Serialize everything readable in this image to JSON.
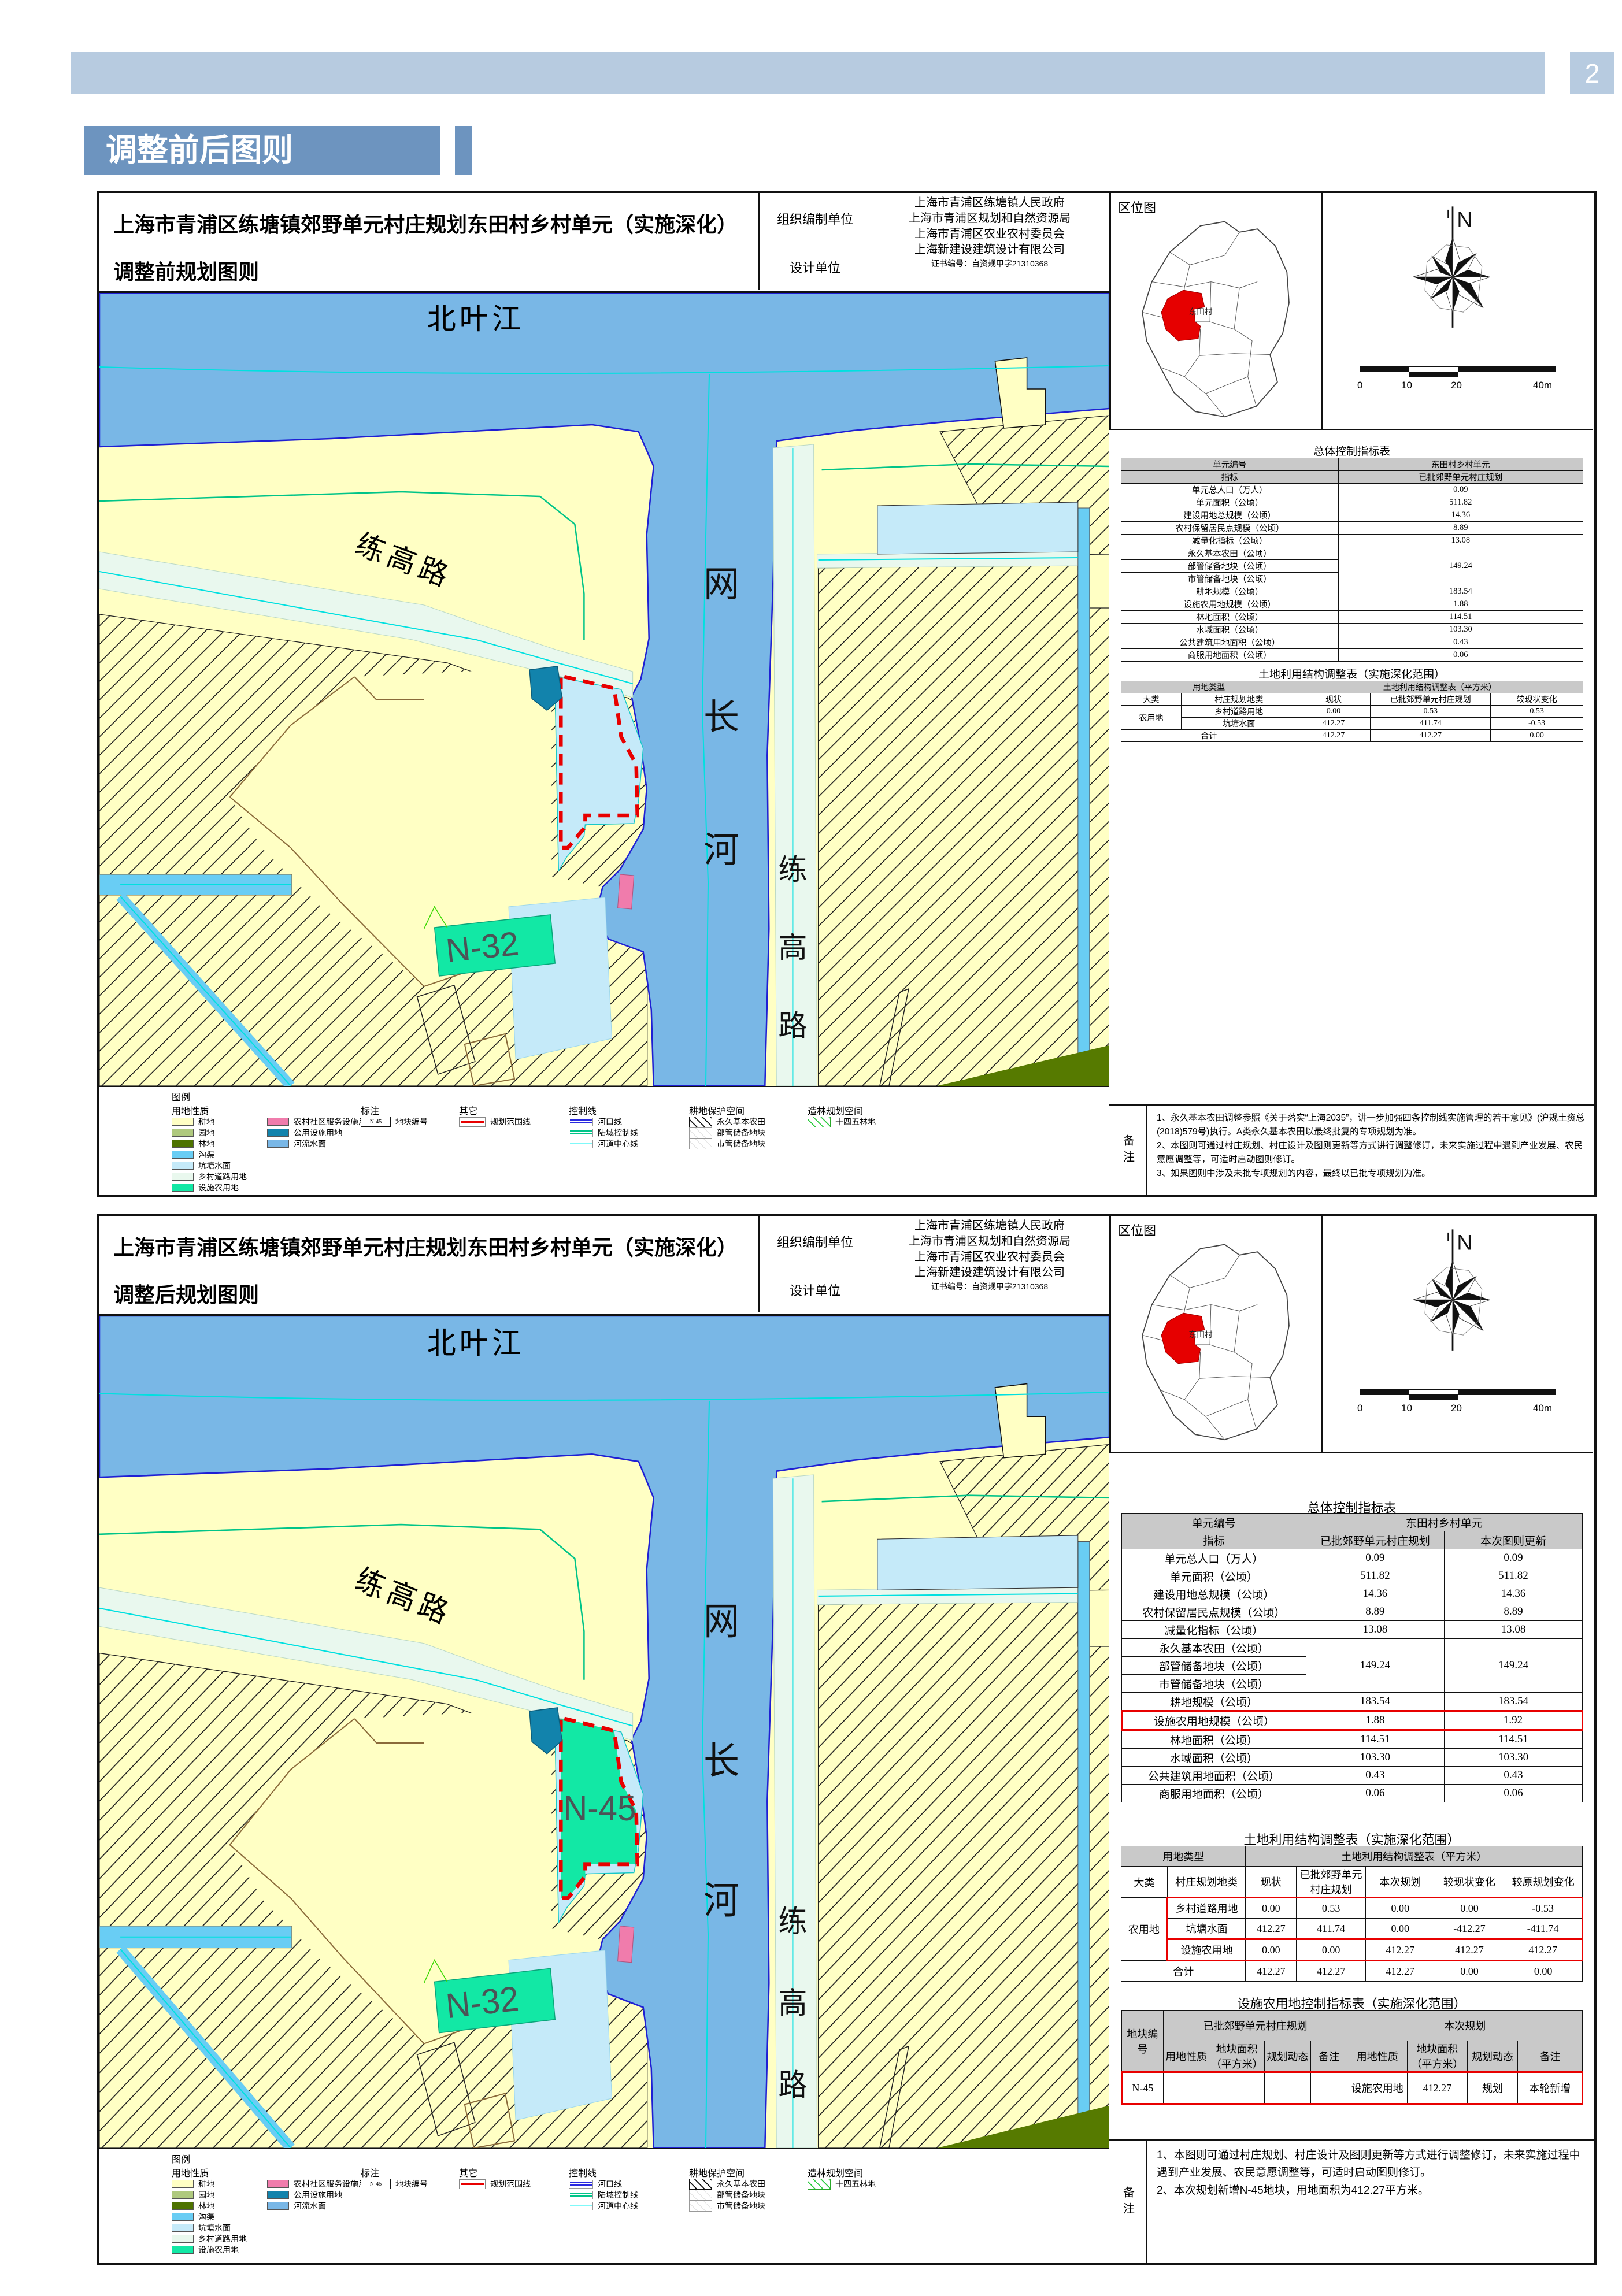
{
  "page": {
    "number": "2"
  },
  "header": {
    "title": "调整前后图则"
  },
  "location": {
    "title": "区位图",
    "north": "N",
    "scale": [
      "0",
      "10",
      "20",
      "40m"
    ],
    "village": "东田村"
  },
  "map": {
    "labels": {
      "river_top": "北叶江",
      "river_main": [
        "网",
        "长",
        "河"
      ],
      "road_diag": "练高路",
      "road_right": [
        "练",
        "高",
        "路"
      ],
      "n32": "N-32",
      "n45": "N-45"
    }
  },
  "colors": {
    "accent_blue": "#6D94BF",
    "band_blue": "#B7CBE0",
    "farmland": "#FFFFC4",
    "orchard": "#AFC97E",
    "forest": "#4E7300",
    "ditch": "#69CDF4",
    "pond": "#C5EAF9",
    "village_road": "#E9F8EE",
    "facility_agri": "#12E8A5",
    "community_service": "#F07CAC",
    "public_utility": "#1283AC",
    "river": "#79B7E6",
    "plan_boundary_red": "#E80000",
    "estuary_line": "#2A2AE0",
    "land_control_line": "#00C488",
    "channel_centerline": "#7FF9F9"
  },
  "legend": {
    "title": "图例",
    "land_header": "用地性质",
    "land_items": [
      {
        "t": "耕地",
        "c": "#FFFFC4"
      },
      {
        "t": "园地",
        "c": "#AFC97E"
      },
      {
        "t": "林地",
        "c": "#4E7300"
      },
      {
        "t": "沟渠",
        "c": "#69CDF4"
      },
      {
        "t": "坑塘水面",
        "c": "#C5EAF9"
      },
      {
        "t": "乡村道路用地",
        "c": "#E9F8EE"
      },
      {
        "t": "设施农用地",
        "c": "#12E8A5"
      }
    ],
    "land_items2": [
      {
        "t": "农村社区服务设施用地",
        "c": "#F07CAC"
      },
      {
        "t": "公用设施用地",
        "c": "#1283AC"
      },
      {
        "t": "河流水面",
        "c": "#79B7E6"
      }
    ],
    "anno_header": "标注",
    "anno_box_text": "N-45",
    "anno_label": "地块编号",
    "other_header": "其它",
    "other_label": "规划范围线",
    "ctrl_header": "控制线",
    "ctrl_items": [
      {
        "t": "河口线",
        "k": "dbl",
        "c": "#2A2AE0"
      },
      {
        "t": "陆域控制线",
        "k": "dbl",
        "c": "#00C488"
      },
      {
        "t": "河道中心线",
        "k": "sgl",
        "c": "#7FF9F9"
      }
    ],
    "arable_header": "耕地保护空间",
    "arable_items": [
      {
        "t": "永久基本农田",
        "k": "hb"
      },
      {
        "t": "部管储备地块",
        "k": "hf"
      },
      {
        "t": "市管储备地块",
        "k": "hf"
      }
    ],
    "forest_header": "造林规划空间",
    "forest_items": [
      {
        "t": "十四五林地",
        "k": "hg"
      }
    ]
  },
  "panel1": {
    "title_line1": "上海市青浦区练塘镇郊野单元村庄规划东田村乡村单元（实施深化）",
    "title_line2": "调整前规划图则",
    "org_label": "组织编制单位",
    "org_units": [
      "上海市青浦区练塘镇人民政府",
      "上海市青浦区规划和自然资源局",
      "上海市青浦区农业农村委员会"
    ],
    "design_label": "设计单位",
    "design_unit": "上海新建设建筑设计有限公司",
    "cert": "证书编号：自资规甲字21310368",
    "t1_title": "总体控制指标表",
    "t1": {
      "cols": [
        47,
        53
      ],
      "rows": [
        [
          {
            "t": "单元编号",
            "h": 1
          },
          {
            "t": "东田村乡村单元",
            "h": 1
          }
        ],
        [
          {
            "t": "指标",
            "h": 1
          },
          {
            "t": "已批郊野单元村庄规划",
            "h": 1
          }
        ],
        [
          {
            "t": "单元总人口（万人）"
          },
          {
            "t": "0.09"
          }
        ],
        [
          {
            "t": "单元面积（公顷）"
          },
          {
            "t": "511.82"
          }
        ],
        [
          {
            "t": "建设用地总规模（公顷）"
          },
          {
            "t": "14.36"
          }
        ],
        [
          {
            "t": "农村保留居民点规模（公顷）"
          },
          {
            "t": "8.89"
          }
        ],
        [
          {
            "t": "减量化指标（公顷）"
          },
          {
            "t": "13.08"
          }
        ],
        [
          {
            "t": "永久基本农田（公顷）"
          },
          {
            "t": "149.24",
            "rs": 3
          }
        ],
        [
          {
            "t": "部管储备地块（公顷）"
          }
        ],
        [
          {
            "t": "市管储备地块（公顷）"
          }
        ],
        [
          {
            "t": "耕地规模（公顷）"
          },
          {
            "t": "183.54"
          }
        ],
        [
          {
            "t": "设施农用地规模（公顷）"
          },
          {
            "t": "1.88"
          }
        ],
        [
          {
            "t": "林地面积（公顷）"
          },
          {
            "t": "114.51"
          }
        ],
        [
          {
            "t": "水域面积（公顷）"
          },
          {
            "t": "103.30"
          }
        ],
        [
          {
            "t": "公共建筑用地面积（公顷）"
          },
          {
            "t": "0.43"
          }
        ],
        [
          {
            "t": "商服用地面积（公顷）"
          },
          {
            "t": "0.06"
          }
        ]
      ]
    },
    "t2_title": "土地利用结构调整表（实施深化范围）",
    "t2": {
      "cols": [
        13,
        25,
        16,
        26,
        20
      ],
      "rows": [
        [
          {
            "t": "用地类型",
            "cs": 2,
            "h": 1
          },
          {
            "t": "土地利用结构调整表（平方米）",
            "cs": 3,
            "h": 1
          }
        ],
        [
          {
            "t": "大类"
          },
          {
            "t": "村庄规划地类"
          },
          {
            "t": "现状"
          },
          {
            "t": "已批郊野单元村庄规划"
          },
          {
            "t": "较现状变化"
          }
        ],
        [
          {
            "t": "农用地",
            "rs": 2
          },
          {
            "t": "乡村道路用地"
          },
          {
            "t": "0.00"
          },
          {
            "t": "0.53"
          },
          {
            "t": "0.53"
          }
        ],
        [
          {
            "t": "坑塘水面"
          },
          {
            "t": "412.27"
          },
          {
            "t": "411.74"
          },
          {
            "t": "-0.53"
          }
        ],
        [
          {
            "t": "合计",
            "cs": 2
          },
          {
            "t": "412.27"
          },
          {
            "t": "412.27"
          },
          {
            "t": "0.00"
          }
        ]
      ]
    },
    "note_label": "备注",
    "notes": [
      "1、永久基本农田调整参照《关于落实“上海2035”，讲一步加强四条控制线实施管理的若干意见》(沪规土资总(2018)579号)执行。A类永久基本农田以最终批复的专项规划为准。",
      "2、本图则可通过村庄规划、村庄设计及图则更新等方式讲行调整修订，未来实施过程中遇到产业发展、农民意愿调整等，可适时启动图则修订。",
      "3、如果图则中涉及未批专项规划的内容，最终以已批专项规划为准。"
    ]
  },
  "panel2": {
    "title_line1": "上海市青浦区练塘镇郊野单元村庄规划东田村乡村单元（实施深化）",
    "title_line2": "调整后规划图则",
    "org_label": "组织编制单位",
    "org_units": [
      "上海市青浦区练塘镇人民政府",
      "上海市青浦区规划和自然资源局",
      "上海市青浦区农业农村委员会"
    ],
    "design_label": "设计单位",
    "design_unit": "上海新建设建筑设计有限公司",
    "cert": "证书编号：自资规甲字21310368",
    "t1_title": "总体控制指标表",
    "t1": {
      "cols": [
        40,
        30,
        30
      ],
      "rows": [
        [
          {
            "t": "单元编号",
            "h": 1
          },
          {
            "t": "东田村乡村单元",
            "h": 1,
            "cs": 2
          }
        ],
        [
          {
            "t": "指标",
            "h": 1
          },
          {
            "t": "已批郊野单元村庄规划",
            "h": 1
          },
          {
            "t": "本次图则更新",
            "h": 1
          }
        ],
        [
          {
            "t": "单元总人口（万人）"
          },
          {
            "t": "0.09"
          },
          {
            "t": "0.09"
          }
        ],
        [
          {
            "t": "单元面积（公顷）"
          },
          {
            "t": "511.82"
          },
          {
            "t": "511.82"
          }
        ],
        [
          {
            "t": "建设用地总规模（公顷）"
          },
          {
            "t": "14.36"
          },
          {
            "t": "14.36"
          }
        ],
        [
          {
            "t": "农村保留居民点规模（公顷）"
          },
          {
            "t": "8.89"
          },
          {
            "t": "8.89"
          }
        ],
        [
          {
            "t": "减量化指标（公顷）"
          },
          {
            "t": "13.08"
          },
          {
            "t": "13.08"
          }
        ],
        [
          {
            "t": "永久基本农田（公顷）"
          },
          {
            "t": "149.24",
            "rs": 3
          },
          {
            "t": "149.24",
            "rs": 3
          }
        ],
        [
          {
            "t": "部管储备地块（公顷）"
          }
        ],
        [
          {
            "t": "市管储备地块（公顷）"
          }
        ],
        [
          {
            "t": "耕地规模（公顷）"
          },
          {
            "t": "183.54"
          },
          {
            "t": "183.54"
          }
        ],
        [
          {
            "t": "设施农用地规模（公顷）",
            "c": "rt rb rl"
          },
          {
            "t": "1.88",
            "c": "rt rb"
          },
          {
            "t": "1.92",
            "c": "rt rb rr"
          }
        ],
        [
          {
            "t": "林地面积（公顷）"
          },
          {
            "t": "114.51"
          },
          {
            "t": "114.51"
          }
        ],
        [
          {
            "t": "水域面积（公顷）"
          },
          {
            "t": "103.30"
          },
          {
            "t": "103.30"
          }
        ],
        [
          {
            "t": "公共建筑用地面积（公顷）"
          },
          {
            "t": "0.43"
          },
          {
            "t": "0.43"
          }
        ],
        [
          {
            "t": "商服用地面积（公顷）"
          },
          {
            "t": "0.06"
          },
          {
            "t": "0.06"
          }
        ]
      ]
    },
    "t2_title": "土地利用结构调整表（实施深化范围）",
    "t2": {
      "cols": [
        10,
        17,
        11,
        15,
        15,
        15,
        17
      ],
      "rows": [
        [
          {
            "t": "用地类型",
            "cs": 2,
            "h": 1
          },
          {
            "t": "土地利用结构调整表（平方米）",
            "cs": 5,
            "h": 1
          }
        ],
        [
          {
            "t": "大类"
          },
          {
            "t": "村庄规划地类"
          },
          {
            "t": "现状"
          },
          {
            "t": "已批郊野单元村庄规划"
          },
          {
            "t": "本次规划"
          },
          {
            "t": "较现状变化"
          },
          {
            "t": "较原规划变化"
          }
        ],
        [
          {
            "t": "农用地",
            "rs": 3
          },
          {
            "t": "乡村道路用地",
            "c": "rt rl"
          },
          {
            "t": "0.00",
            "c": "rt"
          },
          {
            "t": "0.53",
            "c": "rt"
          },
          {
            "t": "0.00",
            "c": "rt"
          },
          {
            "t": "0.00",
            "c": "rt"
          },
          {
            "t": "-0.53",
            "c": "rt rr"
          }
        ],
        [
          {
            "t": "坑塘水面",
            "c": "rb rl"
          },
          {
            "t": "412.27",
            "c": "rb"
          },
          {
            "t": "411.74",
            "c": "rb"
          },
          {
            "t": "0.00",
            "c": "rb"
          },
          {
            "t": "-412.27",
            "c": "rb"
          },
          {
            "t": "-411.74",
            "c": "rb rr"
          }
        ],
        [
          {
            "t": "设施农用地",
            "c": "rt rb rl"
          },
          {
            "t": "0.00",
            "c": "rt rb"
          },
          {
            "t": "0.00",
            "c": "rt rb"
          },
          {
            "t": "412.27",
            "c": "rt rb"
          },
          {
            "t": "412.27",
            "c": "rt rb"
          },
          {
            "t": "412.27",
            "c": "rt rb rr"
          }
        ],
        [
          {
            "t": "合计",
            "cs": 2
          },
          {
            "t": "412.27"
          },
          {
            "t": "412.27"
          },
          {
            "t": "412.27"
          },
          {
            "t": "0.00"
          },
          {
            "t": "0.00"
          }
        ]
      ]
    },
    "t3_title": "设施农用地控制指标表（实施深化范围）",
    "t3": {
      "cols": [
        9,
        10,
        12,
        10,
        8,
        13,
        13,
        11,
        14
      ],
      "rows": [
        [
          {
            "t": "地块编号",
            "rs": 2,
            "h": 1
          },
          {
            "t": "已批郊野单元村庄规划",
            "cs": 4,
            "h": 1
          },
          {
            "t": "本次规划",
            "cs": 4,
            "h": 1
          }
        ],
        [
          {
            "t": "用地性质",
            "h": 1
          },
          {
            "t": "地块面积（平方米）",
            "h": 1
          },
          {
            "t": "规划动态",
            "h": 1
          },
          {
            "t": "备注",
            "h": 1
          },
          {
            "t": "用地性质",
            "h": 1
          },
          {
            "t": "地块面积（平方米）",
            "h": 1
          },
          {
            "t": "规划动态",
            "h": 1
          },
          {
            "t": "备注",
            "h": 1
          }
        ],
        [
          {
            "t": "N-45",
            "c": "rt rb rl"
          },
          {
            "t": "–",
            "c": "rt rb"
          },
          {
            "t": "–",
            "c": "rt rb"
          },
          {
            "t": "–",
            "c": "rt rb"
          },
          {
            "t": "–",
            "c": "rt rb"
          },
          {
            "t": "设施农用地",
            "c": "rt rb"
          },
          {
            "t": "412.27",
            "c": "rt rb"
          },
          {
            "t": "规划",
            "c": "rt rb"
          },
          {
            "t": "本轮新增",
            "c": "rt rb rr"
          }
        ]
      ]
    },
    "note_label": "备注",
    "notes": [
      "1、本图则可通过村庄规划、村庄设计及图则更新等方式进行调整修订，未来实施过程中遇到产业发展、农民意愿调整等，可适时启动图则修订。",
      "2、本次规划新增N-45地块，用地面积为412.27平方米。"
    ]
  }
}
